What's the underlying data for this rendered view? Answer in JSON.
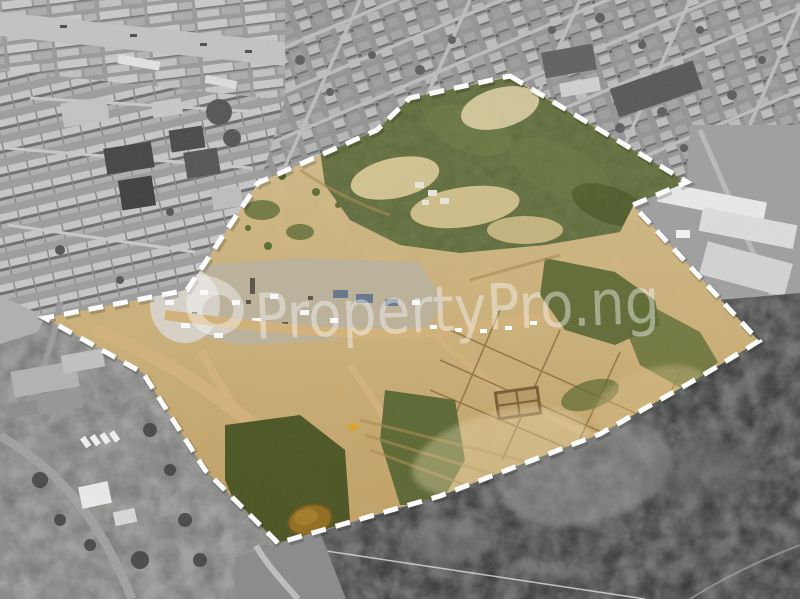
{
  "image": {
    "kind": "aerial-photograph",
    "description": "Aerial view of a large cleared land plot for sale, outlined with a white dashed boundary. Plot interior shown in colour (sand, scrub, pond, access roads); surrounding town, warehouses, industrial yard and wetland shown in grayscale.",
    "width_px": 800,
    "height_px": 599
  },
  "watermark": {
    "text": "PropertyPro.ng",
    "logo": "droplet-logo",
    "color": "#ffffff",
    "opacity": "0.42"
  },
  "boundary": {
    "style": "dashed",
    "color": "#ffffff",
    "dasharray": "15 10",
    "stroke_width": "5"
  },
  "colors": {
    "white": "#ffffff",
    "sandTop": "#d7c494",
    "sandBottom": "#bf9a5a",
    "sandPale": "#e3d4a8",
    "sandTrack": "#a9894f",
    "dirtRoad": "#d3b279",
    "green": "#5d6939",
    "greenDark": "#45501f",
    "greenBright": "#707d46",
    "pond": "#8f6d1f",
    "grayBase": "#9b9b9b",
    "grayRoad": "#c2c2c2",
    "roofLight": "#cdcdcd",
    "roofDark": "#4f4f4f",
    "roofWhite": "#e9e9e9",
    "blueRoof": "#66778a",
    "industrial": "#767676",
    "rubble": "#8a8a8a",
    "marsh": "#333535",
    "marshLight": "#9a9a98",
    "excavator": "#d6a62c"
  }
}
